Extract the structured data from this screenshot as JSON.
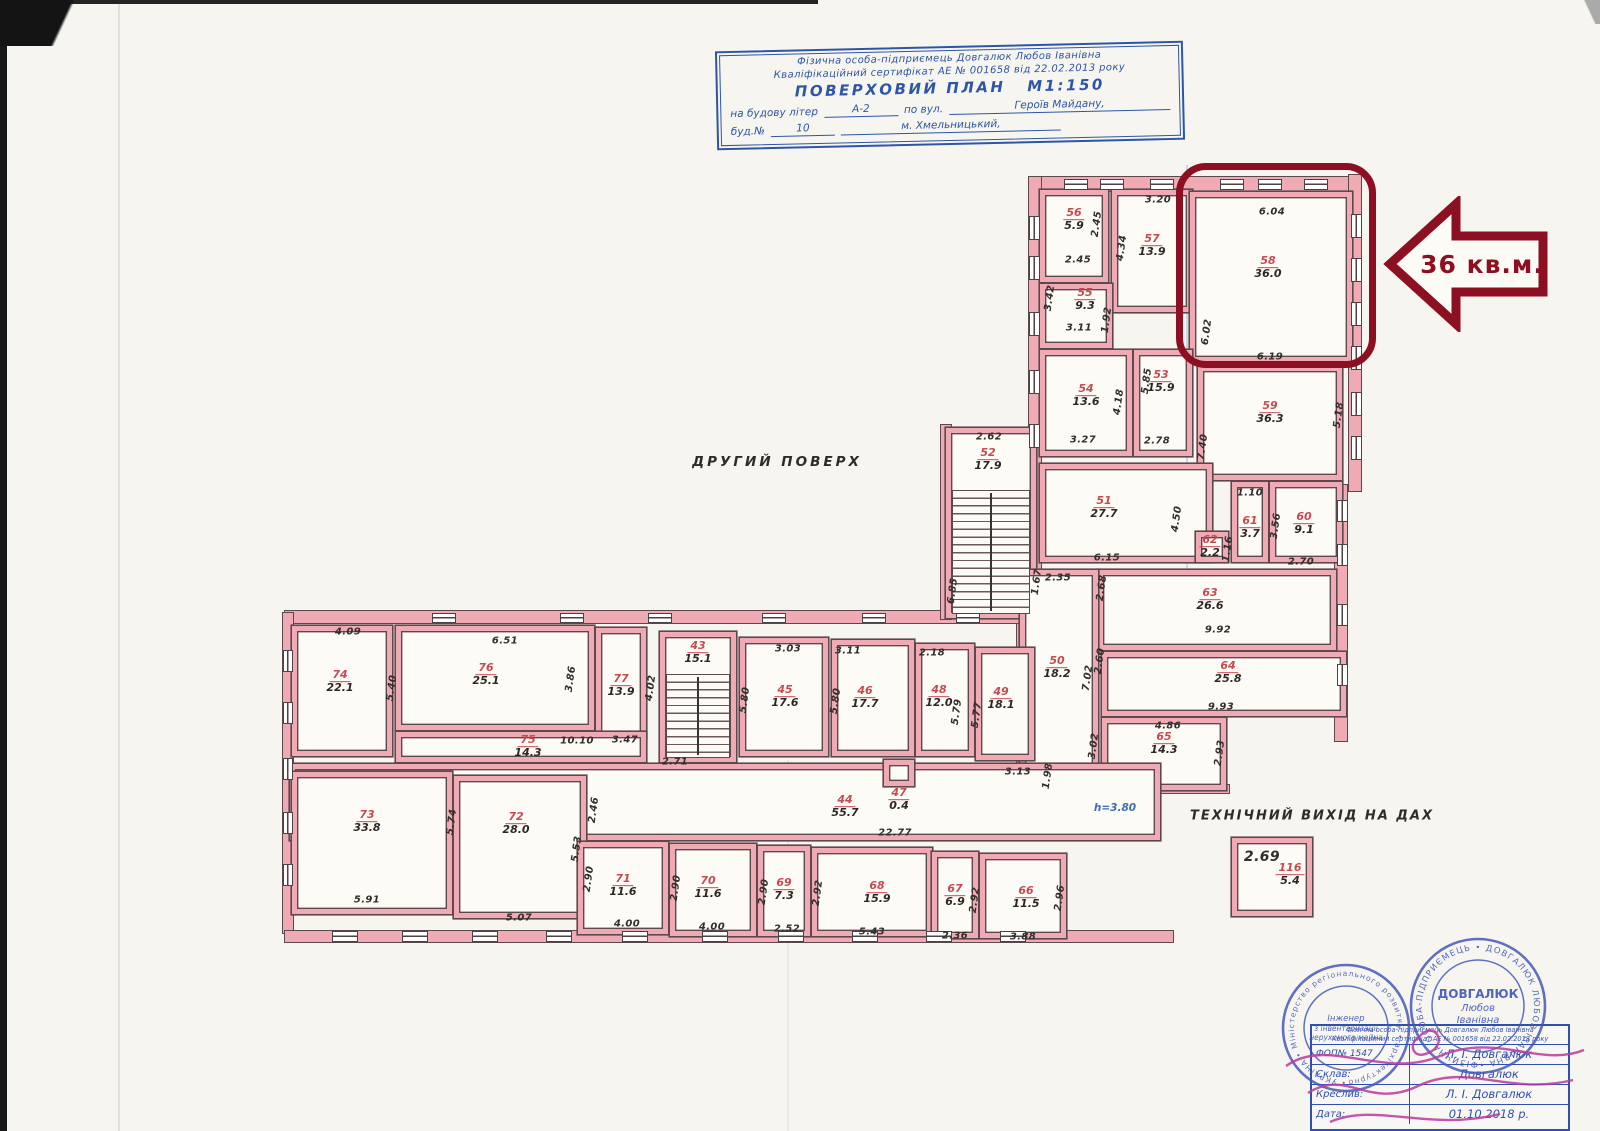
{
  "colors": {
    "wall_pink": "#efaab3",
    "wall_line": "#5c484d",
    "room_number_red": "#c64a50",
    "ink_blue": "#2d55a8",
    "highlight_red": "#8c1021",
    "stamp_blue": "#4054b8",
    "signature_magenta": "#b83aa0"
  },
  "title_block": {
    "line1": "Фізична особа-підприємець Довгалюк Любов Іванівна",
    "line2": "Кваліфікаційний сертифікат АЕ № 001658 від 22.02.2013 року",
    "plan_title": "ПОВЕРХОВИЙ ПЛАН",
    "scale": "М1:150",
    "row1_label": "на будову літер",
    "row1_value": "А-2",
    "row1_mid": "по вул.",
    "row1_street": "Героїв Майдану,",
    "row2_label": "буд.№",
    "row2_value": "10",
    "row2_city": "м. Хмельницький,"
  },
  "plan": {
    "floor_label": "ДРУГИЙ ПОВЕРХ",
    "tech_exit_label": "ТЕХНІЧНИЙ ВИХІД НА ДАХ",
    "height_note": "h=3.80",
    "callout_text": "36 кв.м.",
    "rooms": [
      {
        "num": "56",
        "area": "5.9",
        "x": 1040,
        "y": 190,
        "w": 68,
        "h": 92,
        "lx": 1074,
        "ly": 220
      },
      {
        "num": "57",
        "area": "13.9",
        "x": 1112,
        "y": 190,
        "w": 80,
        "h": 122,
        "lx": 1152,
        "ly": 246
      },
      {
        "num": "58",
        "area": "36.0",
        "x": 1190,
        "y": 192,
        "w": 162,
        "h": 170,
        "lx": 1268,
        "ly": 268
      },
      {
        "num": "55",
        "area": "9.3",
        "x": 1040,
        "y": 284,
        "w": 72,
        "h": 64,
        "lx": 1085,
        "ly": 300
      },
      {
        "num": "54",
        "area": "13.6",
        "x": 1040,
        "y": 350,
        "w": 92,
        "h": 106,
        "lx": 1086,
        "ly": 396
      },
      {
        "num": "53",
        "area": "15.9",
        "x": 1134,
        "y": 350,
        "w": 58,
        "h": 106,
        "lx": 1161,
        "ly": 382
      },
      {
        "num": "59",
        "area": "36.3",
        "x": 1198,
        "y": 366,
        "w": 144,
        "h": 114,
        "lx": 1270,
        "ly": 413
      },
      {
        "num": "52",
        "area": "17.9",
        "x": 946,
        "y": 428,
        "w": 90,
        "h": 190,
        "lx": 988,
        "ly": 460
      },
      {
        "num": "51",
        "area": "27.7",
        "x": 1040,
        "y": 464,
        "w": 172,
        "h": 98,
        "lx": 1104,
        "ly": 508
      },
      {
        "num": "62",
        "area": "2.2",
        "x": 1196,
        "y": 532,
        "w": 32,
        "h": 30,
        "lx": 1210,
        "ly": 547
      },
      {
        "num": "61",
        "area": "3.7",
        "x": 1232,
        "y": 482,
        "w": 36,
        "h": 80,
        "lx": 1250,
        "ly": 528
      },
      {
        "num": "60",
        "area": "9.1",
        "x": 1270,
        "y": 482,
        "w": 72,
        "h": 80,
        "lx": 1304,
        "ly": 524
      },
      {
        "num": "63",
        "area": "26.6",
        "x": 1098,
        "y": 570,
        "w": 238,
        "h": 80,
        "lx": 1210,
        "ly": 600
      },
      {
        "num": "50",
        "area": "18.2",
        "x": 1020,
        "y": 570,
        "w": 78,
        "h": 204,
        "lx": 1057,
        "ly": 668
      },
      {
        "num": "64",
        "area": "25.8",
        "x": 1102,
        "y": 652,
        "w": 244,
        "h": 64,
        "lx": 1228,
        "ly": 673
      },
      {
        "num": "65",
        "area": "14.3",
        "x": 1102,
        "y": 718,
        "w": 124,
        "h": 72,
        "lx": 1164,
        "ly": 744
      },
      {
        "num": "74",
        "area": "22.1",
        "x": 292,
        "y": 626,
        "w": 100,
        "h": 130,
        "lx": 340,
        "ly": 682
      },
      {
        "num": "76",
        "area": "25.1",
        "x": 396,
        "y": 626,
        "w": 198,
        "h": 104,
        "lx": 486,
        "ly": 675
      },
      {
        "num": "77",
        "area": "13.9",
        "x": 596,
        "y": 628,
        "w": 50,
        "h": 110,
        "lx": 621,
        "ly": 686
      },
      {
        "num": "43",
        "area": "15.1",
        "x": 660,
        "y": 632,
        "w": 76,
        "h": 130,
        "lx": 698,
        "ly": 653
      },
      {
        "num": "45",
        "area": "17.6",
        "x": 740,
        "y": 638,
        "w": 88,
        "h": 118,
        "lx": 785,
        "ly": 697
      },
      {
        "num": "46",
        "area": "17.7",
        "x": 832,
        "y": 640,
        "w": 82,
        "h": 116,
        "lx": 865,
        "ly": 698
      },
      {
        "num": "48",
        "area": "12.0",
        "x": 916,
        "y": 644,
        "w": 58,
        "h": 112,
        "lx": 939,
        "ly": 697
      },
      {
        "num": "49",
        "area": "18.1",
        "x": 976,
        "y": 648,
        "w": 58,
        "h": 112,
        "lx": 1001,
        "ly": 699
      },
      {
        "num": "75",
        "area": "14.3",
        "x": 396,
        "y": 732,
        "w": 250,
        "h": 30,
        "lx": 528,
        "ly": 747
      },
      {
        "num": "44",
        "area": "55.7",
        "x": 290,
        "y": 764,
        "w": 870,
        "h": 76,
        "lx": 845,
        "ly": 807
      },
      {
        "num": "47",
        "area": "0.4",
        "x": 884,
        "y": 760,
        "w": 30,
        "h": 26,
        "lx": 899,
        "ly": 800
      },
      {
        "num": "73",
        "area": "33.8",
        "x": 292,
        "y": 772,
        "w": 160,
        "h": 142,
        "lx": 367,
        "ly": 822
      },
      {
        "num": "72",
        "area": "28.0",
        "x": 454,
        "y": 776,
        "w": 132,
        "h": 142,
        "lx": 516,
        "ly": 824
      },
      {
        "num": "71",
        "area": "11.6",
        "x": 578,
        "y": 842,
        "w": 90,
        "h": 92,
        "lx": 623,
        "ly": 886
      },
      {
        "num": "70",
        "area": "11.6",
        "x": 670,
        "y": 844,
        "w": 86,
        "h": 92,
        "lx": 708,
        "ly": 888
      },
      {
        "num": "69",
        "area": "7.3",
        "x": 758,
        "y": 846,
        "w": 52,
        "h": 90,
        "lx": 784,
        "ly": 890
      },
      {
        "num": "68",
        "area": "15.9",
        "x": 812,
        "y": 848,
        "w": 120,
        "h": 88,
        "lx": 877,
        "ly": 893
      },
      {
        "num": "67",
        "area": "6.9",
        "x": 932,
        "y": 852,
        "w": 46,
        "h": 86,
        "lx": 955,
        "ly": 896
      },
      {
        "num": "66",
        "area": "11.5",
        "x": 980,
        "y": 854,
        "w": 86,
        "h": 84,
        "lx": 1026,
        "ly": 898
      },
      {
        "num": "116",
        "area": "5.4",
        "x": 1232,
        "y": 838,
        "w": 80,
        "h": 78,
        "lx": 1290,
        "ly": 875
      }
    ],
    "stairs": [
      {
        "x": 952,
        "y": 490,
        "w": 78,
        "h": 124
      },
      {
        "x": 666,
        "y": 674,
        "w": 64,
        "h": 84
      }
    ],
    "walls": [
      {
        "x": 1030,
        "y": 176,
        "w": 330,
        "h": 16
      },
      {
        "x": 1028,
        "y": 176,
        "w": 14,
        "h": 452
      },
      {
        "x": 1348,
        "y": 174,
        "w": 14,
        "h": 318
      },
      {
        "x": 1334,
        "y": 484,
        "w": 14,
        "h": 258
      },
      {
        "x": 1016,
        "y": 566,
        "w": 12,
        "h": 212
      },
      {
        "x": 284,
        "y": 610,
        "w": 758,
        "h": 14
      },
      {
        "x": 282,
        "y": 612,
        "w": 12,
        "h": 322
      },
      {
        "x": 284,
        "y": 930,
        "w": 890,
        "h": 13
      },
      {
        "x": 940,
        "y": 424,
        "w": 12,
        "h": 196
      },
      {
        "x": 1098,
        "y": 784,
        "w": 132,
        "h": 10
      }
    ],
    "windows": [
      {
        "x": 1064,
        "y": 179,
        "w": 24,
        "h": 11
      },
      {
        "x": 1100,
        "y": 179,
        "w": 24,
        "h": 11
      },
      {
        "x": 1150,
        "y": 179,
        "w": 24,
        "h": 11
      },
      {
        "x": 1220,
        "y": 179,
        "w": 24,
        "h": 11
      },
      {
        "x": 1258,
        "y": 179,
        "w": 24,
        "h": 11
      },
      {
        "x": 1304,
        "y": 179,
        "w": 24,
        "h": 11
      },
      {
        "x": 1029,
        "y": 216,
        "w": 11,
        "h": 24
      },
      {
        "x": 1029,
        "y": 256,
        "w": 11,
        "h": 24
      },
      {
        "x": 1029,
        "y": 312,
        "w": 11,
        "h": 24
      },
      {
        "x": 1029,
        "y": 370,
        "w": 11,
        "h": 24
      },
      {
        "x": 1029,
        "y": 424,
        "w": 11,
        "h": 24
      },
      {
        "x": 1351,
        "y": 214,
        "w": 11,
        "h": 24
      },
      {
        "x": 1351,
        "y": 258,
        "w": 11,
        "h": 24
      },
      {
        "x": 1351,
        "y": 302,
        "w": 11,
        "h": 24
      },
      {
        "x": 1351,
        "y": 346,
        "w": 11,
        "h": 24
      },
      {
        "x": 1351,
        "y": 392,
        "w": 11,
        "h": 24
      },
      {
        "x": 1351,
        "y": 436,
        "w": 11,
        "h": 24
      },
      {
        "x": 1337,
        "y": 500,
        "w": 11,
        "h": 22
      },
      {
        "x": 1337,
        "y": 544,
        "w": 11,
        "h": 22
      },
      {
        "x": 1337,
        "y": 604,
        "w": 11,
        "h": 22
      },
      {
        "x": 1337,
        "y": 664,
        "w": 11,
        "h": 22
      },
      {
        "x": 432,
        "y": 613,
        "w": 24,
        "h": 10
      },
      {
        "x": 560,
        "y": 613,
        "w": 24,
        "h": 10
      },
      {
        "x": 648,
        "y": 613,
        "w": 24,
        "h": 10
      },
      {
        "x": 762,
        "y": 613,
        "w": 24,
        "h": 10
      },
      {
        "x": 862,
        "y": 613,
        "w": 24,
        "h": 10
      },
      {
        "x": 956,
        "y": 613,
        "w": 24,
        "h": 10
      },
      {
        "x": 283,
        "y": 650,
        "w": 10,
        "h": 22
      },
      {
        "x": 283,
        "y": 702,
        "w": 10,
        "h": 22
      },
      {
        "x": 283,
        "y": 758,
        "w": 10,
        "h": 22
      },
      {
        "x": 283,
        "y": 812,
        "w": 10,
        "h": 22
      },
      {
        "x": 283,
        "y": 864,
        "w": 10,
        "h": 22
      },
      {
        "x": 332,
        "y": 931,
        "w": 26,
        "h": 11
      },
      {
        "x": 402,
        "y": 931,
        "w": 26,
        "h": 11
      },
      {
        "x": 472,
        "y": 931,
        "w": 26,
        "h": 11
      },
      {
        "x": 546,
        "y": 931,
        "w": 26,
        "h": 11
      },
      {
        "x": 622,
        "y": 931,
        "w": 26,
        "h": 11
      },
      {
        "x": 702,
        "y": 931,
        "w": 26,
        "h": 11
      },
      {
        "x": 778,
        "y": 931,
        "w": 26,
        "h": 11
      },
      {
        "x": 852,
        "y": 931,
        "w": 26,
        "h": 11
      },
      {
        "x": 926,
        "y": 931,
        "w": 26,
        "h": 11
      },
      {
        "x": 1000,
        "y": 931,
        "w": 26,
        "h": 11
      }
    ],
    "dims": [
      {
        "t": "3.20",
        "x": 1158,
        "y": 200
      },
      {
        "t": "2.45",
        "x": 1097,
        "y": 224,
        "r": -82
      },
      {
        "t": "2.45",
        "x": 1078,
        "y": 260
      },
      {
        "t": "4.34",
        "x": 1122,
        "y": 248,
        "r": -82
      },
      {
        "t": "1.92",
        "x": 1107,
        "y": 320,
        "r": -82
      },
      {
        "t": "3.42",
        "x": 1050,
        "y": 298,
        "r": -82
      },
      {
        "t": "6.04",
        "x": 1272,
        "y": 212
      },
      {
        "t": "6.02",
        "x": 1207,
        "y": 332,
        "r": -82
      },
      {
        "t": "6.19",
        "x": 1270,
        "y": 357
      },
      {
        "t": "3.11",
        "x": 1079,
        "y": 328
      },
      {
        "t": "5.85",
        "x": 1147,
        "y": 381,
        "r": -82
      },
      {
        "t": "4.18",
        "x": 1119,
        "y": 402,
        "r": -82
      },
      {
        "t": "3.27",
        "x": 1083,
        "y": 440
      },
      {
        "t": "2.78",
        "x": 1157,
        "y": 441
      },
      {
        "t": "7.40",
        "x": 1203,
        "y": 447,
        "r": -82
      },
      {
        "t": "5.18",
        "x": 1339,
        "y": 415,
        "r": -82
      },
      {
        "t": "2.62",
        "x": 989,
        "y": 437
      },
      {
        "t": "4.50",
        "x": 1177,
        "y": 519,
        "r": -82
      },
      {
        "t": "6.15",
        "x": 1107,
        "y": 558
      },
      {
        "t": "2.35",
        "x": 1058,
        "y": 578
      },
      {
        "t": "1.10",
        "x": 1250,
        "y": 493
      },
      {
        "t": "3.56",
        "x": 1276,
        "y": 526,
        "r": -82
      },
      {
        "t": "1.16",
        "x": 1228,
        "y": 549,
        "r": -82
      },
      {
        "t": "2.70",
        "x": 1301,
        "y": 562
      },
      {
        "t": "6.85",
        "x": 953,
        "y": 591,
        "r": -82
      },
      {
        "t": "1.67",
        "x": 1037,
        "y": 582,
        "r": -82
      },
      {
        "t": "2.68",
        "x": 1102,
        "y": 588,
        "r": -82
      },
      {
        "t": "2.60",
        "x": 1100,
        "y": 661,
        "r": -82
      },
      {
        "t": "9.92",
        "x": 1218,
        "y": 630
      },
      {
        "t": "9.93",
        "x": 1221,
        "y": 707
      },
      {
        "t": "7.02",
        "x": 1088,
        "y": 678,
        "r": -82
      },
      {
        "t": "4.86",
        "x": 1168,
        "y": 726
      },
      {
        "t": "3.02",
        "x": 1094,
        "y": 746,
        "r": -82
      },
      {
        "t": "2.93",
        "x": 1220,
        "y": 753,
        "r": -82
      },
      {
        "t": "3.13",
        "x": 1018,
        "y": 772
      },
      {
        "t": "1.98",
        "x": 1048,
        "y": 776,
        "r": -82
      },
      {
        "t": "4.09",
        "x": 348,
        "y": 632
      },
      {
        "t": "6.51",
        "x": 505,
        "y": 641
      },
      {
        "t": "5.40",
        "x": 392,
        "y": 688,
        "r": -82
      },
      {
        "t": "3.86",
        "x": 571,
        "y": 679,
        "r": -82
      },
      {
        "t": "3.47",
        "x": 625,
        "y": 740
      },
      {
        "t": "4.02",
        "x": 651,
        "y": 688,
        "r": -82
      },
      {
        "t": "3.03",
        "x": 788,
        "y": 649
      },
      {
        "t": "5.80",
        "x": 745,
        "y": 700,
        "r": -82
      },
      {
        "t": "3.11",
        "x": 848,
        "y": 651
      },
      {
        "t": "5.80",
        "x": 836,
        "y": 701,
        "r": -82
      },
      {
        "t": "2.18",
        "x": 932,
        "y": 653
      },
      {
        "t": "5.79",
        "x": 957,
        "y": 712,
        "r": -82
      },
      {
        "t": "5.77",
        "x": 977,
        "y": 715,
        "r": -82
      },
      {
        "t": "10.10",
        "x": 577,
        "y": 741
      },
      {
        "t": "2.71",
        "x": 675,
        "y": 762
      },
      {
        "t": "22.77",
        "x": 895,
        "y": 833
      },
      {
        "t": "2.46",
        "x": 594,
        "y": 810,
        "r": -82
      },
      {
        "t": "5.74",
        "x": 452,
        "y": 822,
        "r": -82
      },
      {
        "t": "5.91",
        "x": 367,
        "y": 900
      },
      {
        "t": "5.53",
        "x": 577,
        "y": 849,
        "r": -82
      },
      {
        "t": "2.90",
        "x": 589,
        "y": 879,
        "r": -82
      },
      {
        "t": "5.07",
        "x": 519,
        "y": 918
      },
      {
        "t": "2.90",
        "x": 676,
        "y": 888,
        "r": -82
      },
      {
        "t": "2.90",
        "x": 764,
        "y": 892,
        "r": -82
      },
      {
        "t": "2.92",
        "x": 818,
        "y": 893,
        "r": -82
      },
      {
        "t": "2.92",
        "x": 975,
        "y": 900,
        "r": -82
      },
      {
        "t": "2.96",
        "x": 1060,
        "y": 898,
        "r": -82
      },
      {
        "t": "4.00",
        "x": 627,
        "y": 924
      },
      {
        "t": "4.00",
        "x": 712,
        "y": 927
      },
      {
        "t": "2.52",
        "x": 787,
        "y": 929
      },
      {
        "t": "5.43",
        "x": 872,
        "y": 932
      },
      {
        "t": "2.36",
        "x": 955,
        "y": 936
      },
      {
        "t": "3.88",
        "x": 1023,
        "y": 937
      },
      {
        "t": "2.69",
        "x": 1262,
        "y": 857,
        "s": 14
      }
    ]
  },
  "stamps": {
    "stamp1_ring": "• УКРАЇНА • Міністерство регіонального розвитку • архітектурно-будівельна комісія",
    "stamp1_c1": "Інженер",
    "stamp1_c2": "з інвентаризації",
    "stamp1_c3": "нерухомого майна",
    "stamp2_ring": "ФІЗИЧНА ОСОБА-ПІДПРИЄМЕЦЬ • ДОВГАЛЮК ЛЮБОВ ІВАНІВНА •",
    "stamp2_c1": "ДОВГАЛЮК",
    "stamp2_c2": "Любов",
    "stamp2_c3": "Іванівна"
  },
  "sign_table": {
    "header1": "Фізична особа-підприємець Довгалюк Любов Іванівна",
    "header2": "Кваліфікаційний сертифікат АЕ № 001658 від 22.02.2013 року",
    "rows": [
      {
        "label": "ФОП№ 1547",
        "value": "Л. І. Довгалюк"
      },
      {
        "label": "Склав:",
        "value": "Довгалюк"
      },
      {
        "label": "Креслив:",
        "value": "Л. І. Довгалюк"
      },
      {
        "label": "Дата:",
        "value": "01.10.2018 р."
      }
    ]
  }
}
